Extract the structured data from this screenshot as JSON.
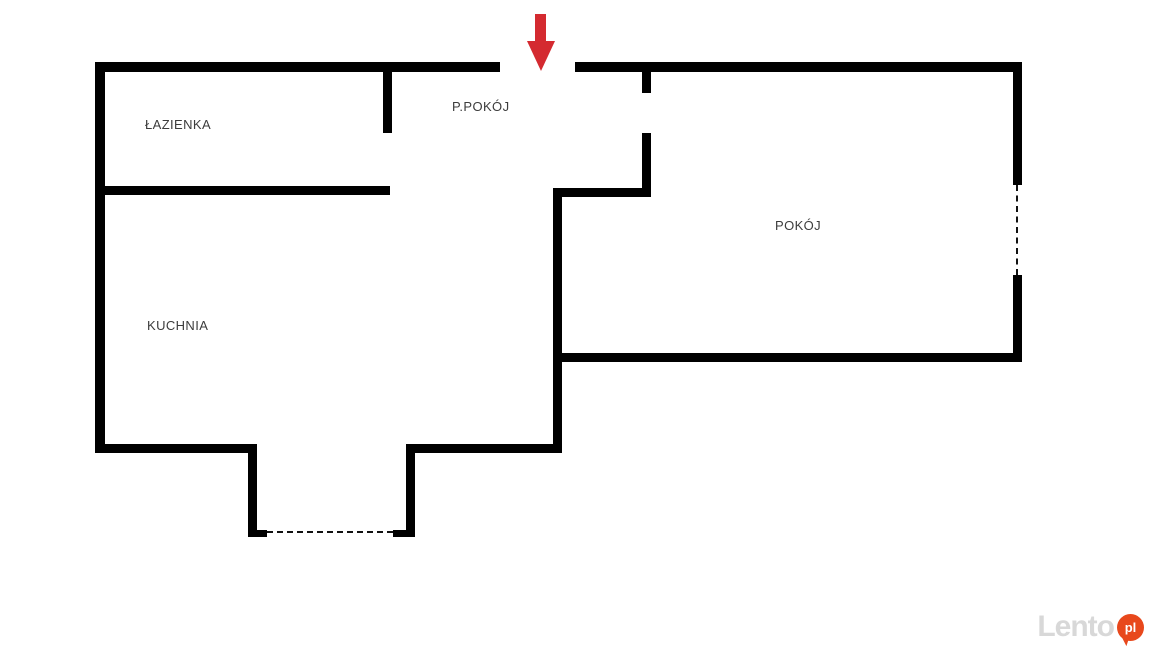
{
  "floorplan": {
    "rooms": [
      {
        "id": "lazienka",
        "label": "ŁAZIENKA"
      },
      {
        "id": "ppokoj",
        "label": "P.POKÓJ"
      },
      {
        "id": "kuchnia",
        "label": "KUCHNIA"
      },
      {
        "id": "pokoj",
        "label": "POKÓJ"
      }
    ],
    "entrance_arrow": {
      "direction": "down",
      "color": "#d42a30"
    },
    "colors": {
      "wall": "#000000",
      "background": "#ffffff",
      "label_text": "#3c3c3c"
    }
  },
  "watermark": {
    "brand": "Lento",
    "suffix": "pl",
    "text_color": "#d8d8d8",
    "bubble_color": "#e8481c"
  }
}
